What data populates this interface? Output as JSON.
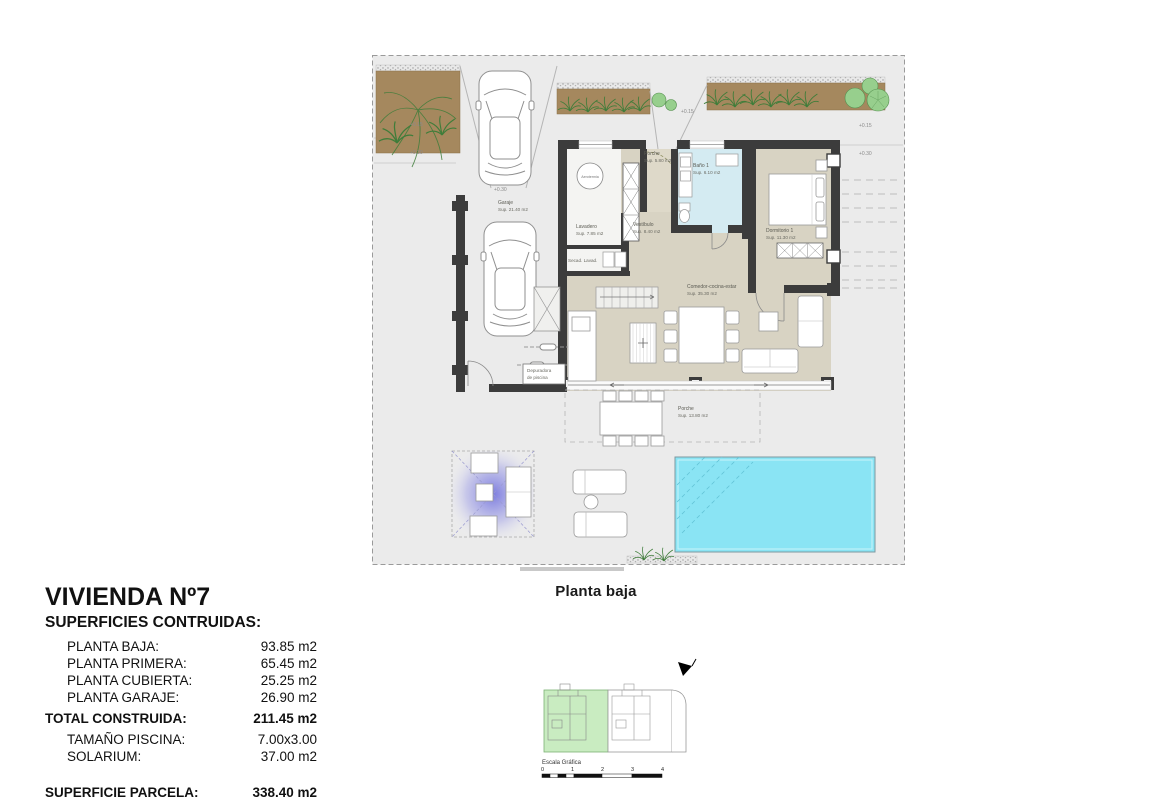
{
  "title_block": {
    "title": "VIVIENDA Nº7",
    "subtitle": "SUPERFICIES CONTRUIDAS:",
    "rows": [
      {
        "label": "PLANTA BAJA:",
        "value": "93.85 m2"
      },
      {
        "label": "PLANTA PRIMERA:",
        "value": "65.45 m2"
      },
      {
        "label": "PLANTA CUBIERTA:",
        "value": "25.25 m2"
      },
      {
        "label": "PLANTA GARAJE:",
        "value": "26.90 m2"
      },
      {
        "label": "TOTAL CONSTRUIDA:",
        "value": "211.45 m2"
      },
      {
        "label": "TAMAÑO PISCINA:",
        "value": "7.00x3.00"
      },
      {
        "label": "SOLARIUM:",
        "value": "37.00 m2"
      },
      {
        "label": "SUPERFICIE PARCELA:",
        "value": "338.40 m2"
      }
    ]
  },
  "plan": {
    "caption": "Planta baja",
    "rooms": {
      "garaje": {
        "name": "Garaje",
        "area": "Sup. 21.40 m2"
      },
      "lavadero": {
        "name": "Lavadero",
        "area": "Sup. 7.85 m2"
      },
      "secadero": {
        "name": "Secad. Lavad."
      },
      "vestibulo": {
        "name": "Vestíbulo",
        "area": "Sup. 8.40 m2"
      },
      "bano1": {
        "name": "Baño 1",
        "area": "Sup. 6.10 m2"
      },
      "dormitorio1": {
        "name": "Dormitorio 1",
        "area": "Sup. 11.30 m2"
      },
      "comedor": {
        "name": "Comedor-cocina-estar",
        "area": "Sup. 35.30 m2"
      },
      "porche_entrada": {
        "name": "Porche",
        "area": "Sup. 5.80 m2"
      },
      "porche_terraza": {
        "name": "Porche",
        "area": "Sup. 13.80 m2"
      },
      "depuradora": {
        "line1": "Depuradora",
        "line2": "de piscina"
      },
      "aerotermia": {
        "name": "Aerotermia"
      }
    },
    "levels": {
      "left_upper": "+0.15",
      "left_lower": "+0.30",
      "entry": "+0.15",
      "right_upper": "+0.15",
      "right_lower": "+0.30",
      "garage": "+0.30"
    }
  },
  "site_plan": {
    "scale_label": "Escala Gráfica",
    "ticks": [
      "0",
      "1",
      "2",
      "3",
      "4"
    ]
  },
  "colors": {
    "wall": "#3c3c3c",
    "floor": "#d8d3c3",
    "floor2": "#ded9c9",
    "bath": "#d4ebf2",
    "pool": "#8ae4f4",
    "plot": "#ebebeb",
    "bed": "#a5885e",
    "plant": "#3f7d3a",
    "site-green": "#c9ecc1"
  }
}
